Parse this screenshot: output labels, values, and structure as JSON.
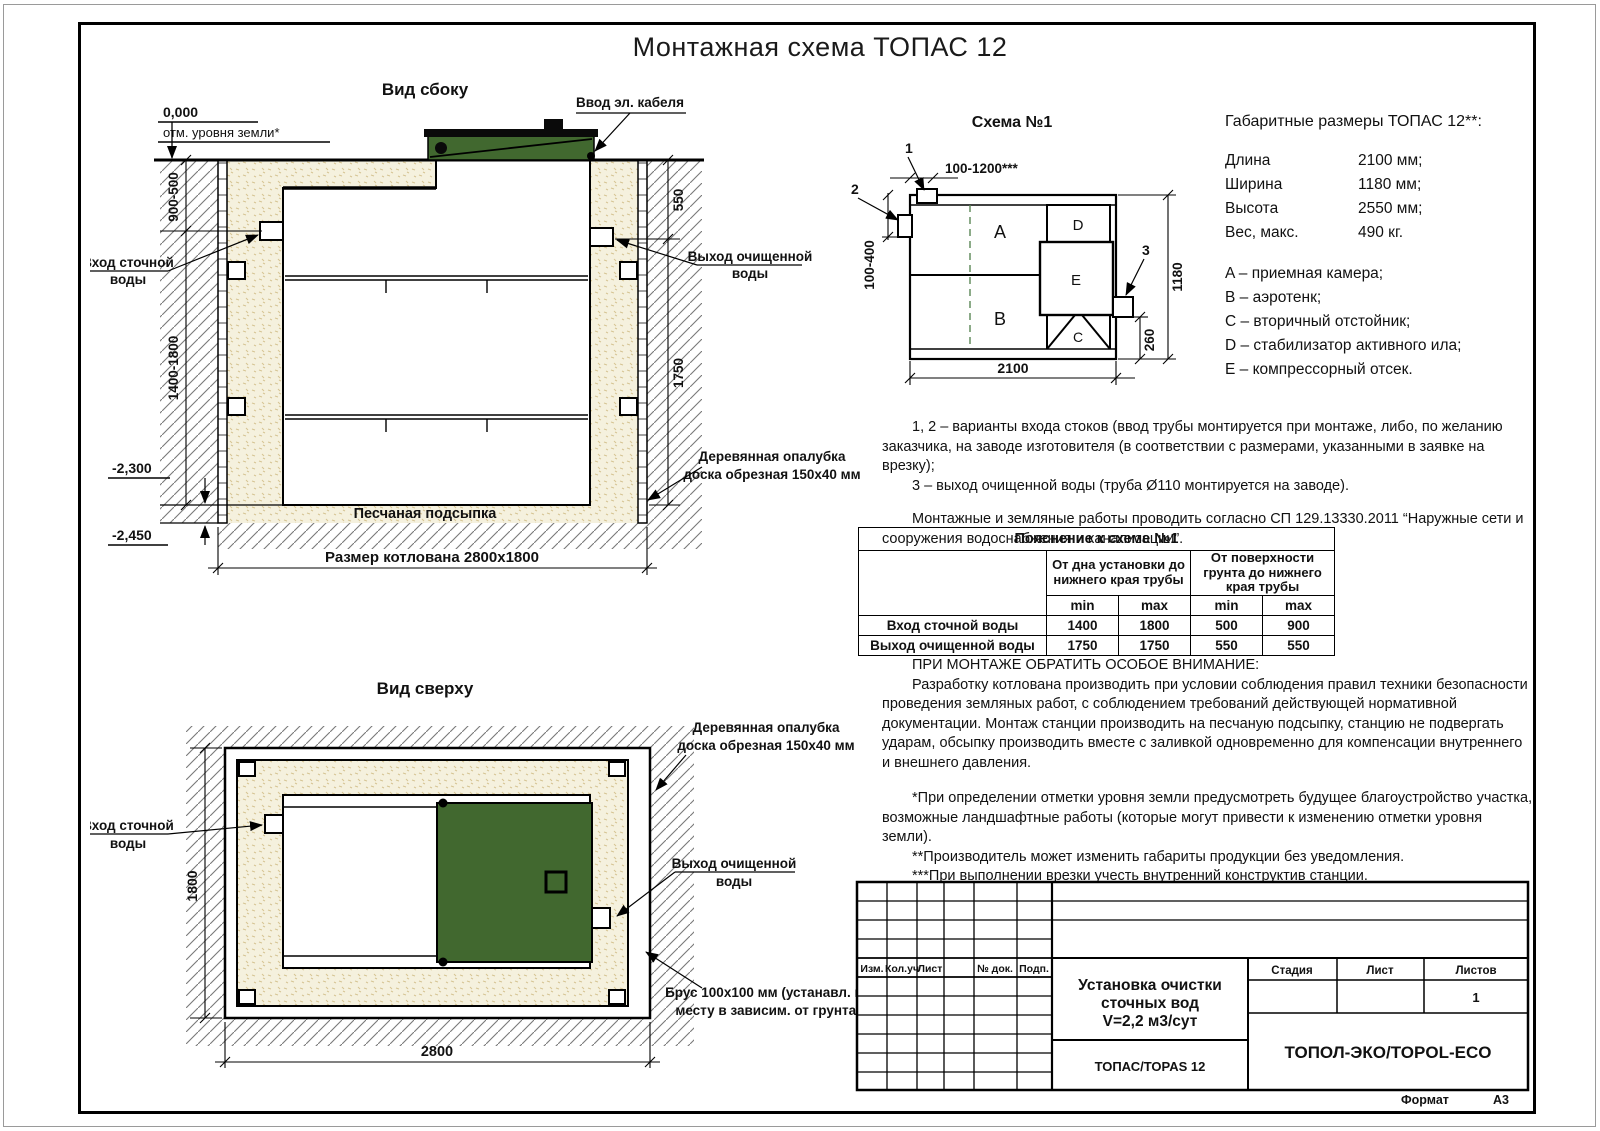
{
  "page": {
    "title": "Монтажная схема ТОПАС 12",
    "format_label": "Формат",
    "format_value": "А3"
  },
  "colors": {
    "green": "#41682f",
    "sand_bg": "#f5f1de",
    "sand_dot": "#d6c493",
    "hatch_line": "#787878"
  },
  "side_view": {
    "title": "Вид сбоку",
    "zero_mark": "0,000",
    "ground_mark": "отм. уровня земли*",
    "cable_label": "Ввод эл. кабеля",
    "inlet_label": [
      "Вход сточной",
      "воды"
    ],
    "outlet_label": [
      "Выход очищенной",
      "воды"
    ],
    "formwork_label": [
      "Деревянная опалубка",
      "доска обрезная 150х40 мм"
    ],
    "sand_label": "Песчаная подсыпка",
    "pit_dim": "Размер котлована 2800x1800",
    "dim_900_500": "900-500",
    "dim_1400_1800": "1400-1800",
    "dim_550": "550",
    "dim_1750": "1750",
    "level_2300": "-2,300",
    "level_2450": "-2,450"
  },
  "schema": {
    "title": "Схема №1",
    "marker_1": "1",
    "marker_2": "2",
    "marker_3": "3",
    "dim_top": "100-1200***",
    "dim_left": "100-400",
    "dim_right": "1180",
    "dim_260": "260",
    "dim_bottom": "2100",
    "compartments": {
      "a": "A",
      "b": "B",
      "c": "C",
      "d": "D",
      "e": "E"
    }
  },
  "specs": {
    "title": "Габаритные размеры ТОПАС 12**:",
    "rows": [
      {
        "label": "Длина",
        "value": "2100 мм;"
      },
      {
        "label": "Ширина",
        "value": "1180 мм;"
      },
      {
        "label": "Высота",
        "value": "2550 мм;"
      },
      {
        "label": "Вес, макс.",
        "value": "490 кг."
      }
    ],
    "legend": [
      "A – приемная камера;",
      "B – аэротенк;",
      "C – вторичный отстойник;",
      "D – стабилизатор активного ила;",
      "E – компрессорный отсек."
    ]
  },
  "notes": {
    "note_1": "1, 2 – варианты входа  стоков (ввод трубы монтируется при монтаже, либо, по желанию заказчика, на заводе изготовителя (в соответствии с размерами, указанными в заявке на врезку);",
    "note_2": "3 – выход очищенной воды (труба Ø110 монтируется на заводе).",
    "note_3": "Монтажные и земляные работы проводить согласно СП 129.13330.2011 “Наружные сети и сооружения водоснабжения и канализации”."
  },
  "table": {
    "caption": "Пояснение к схеме №1",
    "col_group_1": "От дна установки до нижнего края трубы",
    "col_group_2": "От поверхности грунта до нижнего края трубы",
    "min_label": "min",
    "max_label": "max",
    "rows": [
      {
        "label": "Вход сточной воды",
        "v1": "1400",
        "v2": "1800",
        "v3": "500",
        "v4": "900"
      },
      {
        "label": "Выход очищенной воды",
        "v1": "1750",
        "v2": "1750",
        "v3": "550",
        "v4": "550"
      }
    ]
  },
  "warning": {
    "title": "ПРИ МОНТАЖЕ ОБРАТИТЬ ОСОБОЕ ВНИМАНИЕ:",
    "para_1": "Разработку котлована производить при условии соблюдения правил техники безопасности проведения земляных работ, с соблюдением требований действующей нормативной документации. Монтаж станции производить на песчаную подсыпку, станцию не подвергать ударам, обсыпку производить вместе с заливкой одновременно для компенсации внутреннего и внешнего давления.",
    "footnote_1": "*При определении отметки уровня земли предусмотреть будущее благоустройство участка, возможные ландшафтные работы (которые могут привести к изменению отметки уровня земли).",
    "footnote_2": "**Производитель может изменить габариты продукции без уведомления.",
    "footnote_3": "***При выполнении врезки учесть внутренний конструктив станции.",
    "consumption": "Расход песка не менее – 7,6 м³, расход воды не менее – 3,2 м³."
  },
  "top_view": {
    "title": "Вид сверху",
    "inlet_label": [
      "Вход сточной",
      "воды"
    ],
    "outlet_label": [
      "Выход очищенной",
      "воды"
    ],
    "formwork_label": [
      "Деревянная опалубка",
      "доска обрезная 150х40 мм"
    ],
    "beam_label": [
      "Брус 100x100 мм (устанавл. по",
      "месту в зависим. от грунта)"
    ],
    "dim_width": "2800",
    "dim_height": "1800"
  },
  "title_block": {
    "rev_headers": [
      "Изм.",
      "Кол.уч",
      "Лист",
      "№ док.",
      "Подп.",
      "Дата"
    ],
    "stage_label": "Стадия",
    "sheet_label": "Лист",
    "sheets_label": "Листов",
    "sheets_value": "1",
    "doc_title": [
      "Установка очистки",
      "сточных вод",
      "V=2,2 м3/сут"
    ],
    "product": "ТОПАС/TOPAS 12",
    "company": "ТОПОЛ-ЭКО/TOPOL-ECO"
  }
}
